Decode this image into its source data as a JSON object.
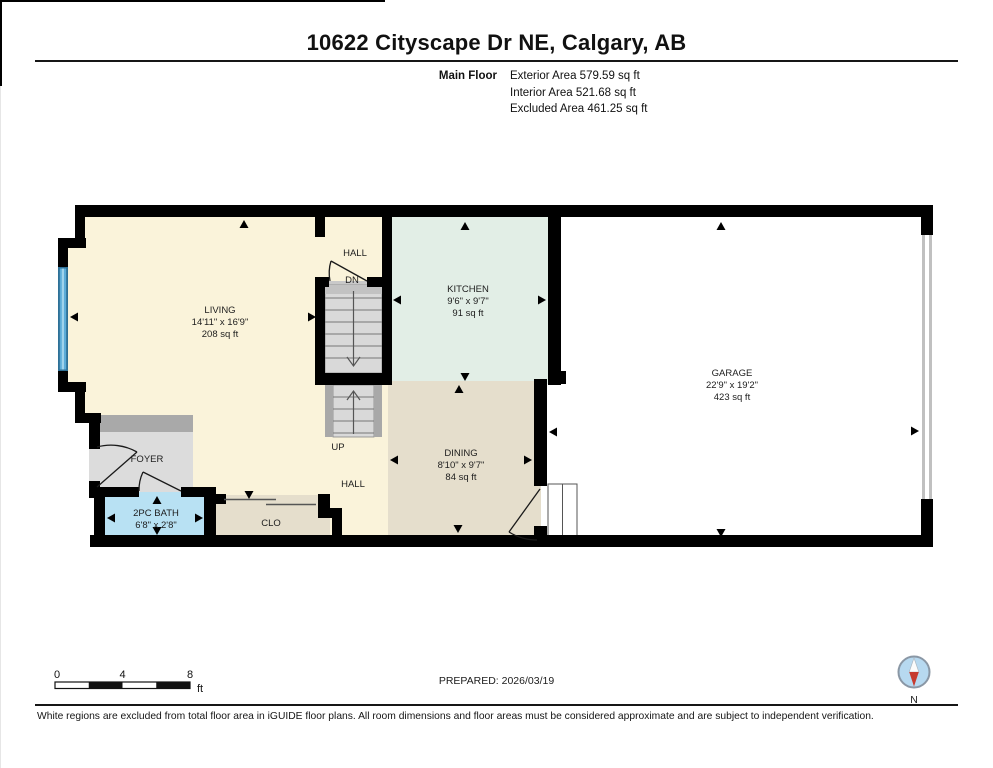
{
  "header": {
    "title": "10622 Cityscape Dr NE, Calgary, AB",
    "floor_label": "Main Floor",
    "stats": [
      "Exterior Area 579.59 sq ft",
      "Interior Area 521.68 sq ft",
      "Excluded Area 461.25 sq ft"
    ]
  },
  "plan": {
    "living": {
      "name": "LIVING",
      "dims": "14'11\" x 16'9\"",
      "area": "208 sq ft"
    },
    "kitchen": {
      "name": "KITCHEN",
      "dims": "9'6\" x 9'7\"",
      "area": "91 sq ft"
    },
    "dining": {
      "name": "DINING",
      "dims": "8'10\" x 9'7\"",
      "area": "84 sq ft"
    },
    "garage": {
      "name": "GARAGE",
      "dims": "22'9\" x 19'2\"",
      "area": "423 sq ft"
    },
    "bath": {
      "name": "2PC BATH",
      "dims": "6'8\" x 2'8\""
    },
    "foyer": {
      "name": "FOYER"
    },
    "clo": {
      "name": "CLO"
    },
    "hall_upper": {
      "name": "HALL"
    },
    "hall_lower": {
      "name": "HALL"
    },
    "dn": {
      "label": "DN"
    },
    "up": {
      "label": "UP"
    }
  },
  "colors": {
    "living": "#FAF3DA",
    "kitchen": "#E2EEE6",
    "dining": "#E5DECC",
    "garage": "#FFFFFF",
    "foyer": "#DCDCDC",
    "bath": "#B8E1F3",
    "clo": "#E5DECC",
    "window": "#5CACD8",
    "wall": "#000000",
    "compass_face": "#B7D9F0",
    "compass_needle": "#C63B2F"
  },
  "footer": {
    "scale": {
      "ticks": [
        "0",
        "4",
        "8"
      ],
      "unit": "ft"
    },
    "prepared": "PREPARED: 2026/03/19",
    "compass_label": "N",
    "disclaimer": "White regions are excluded from total floor area in iGUIDE floor plans. All room dimensions and floor areas must be considered approximate and are subject to independent verification."
  }
}
